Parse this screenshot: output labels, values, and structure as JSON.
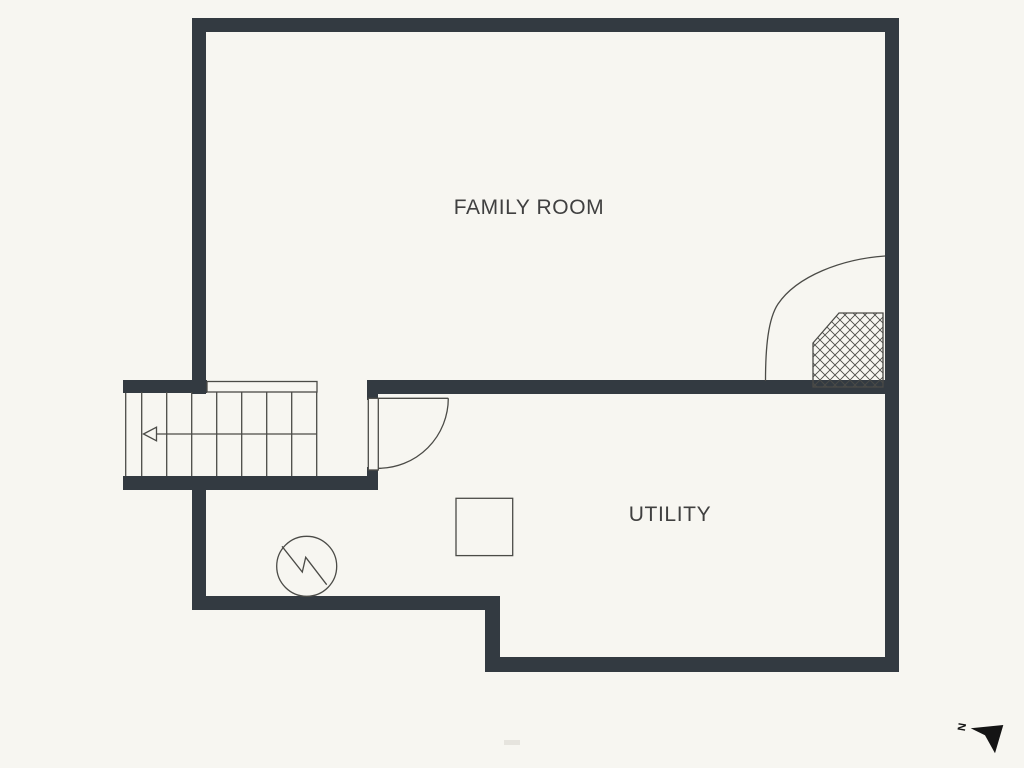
{
  "rooms": {
    "family_room": {
      "label": "FAMILY ROOM"
    },
    "utility": {
      "label": "UTILITY"
    }
  },
  "compass": {
    "north_label": "N"
  },
  "colors": {
    "background": "#f7f6f1",
    "wall": "#333a41",
    "line": "#4b4b47",
    "text": "#404040",
    "compass": "#141414",
    "watermark": "#d9d6cd"
  }
}
